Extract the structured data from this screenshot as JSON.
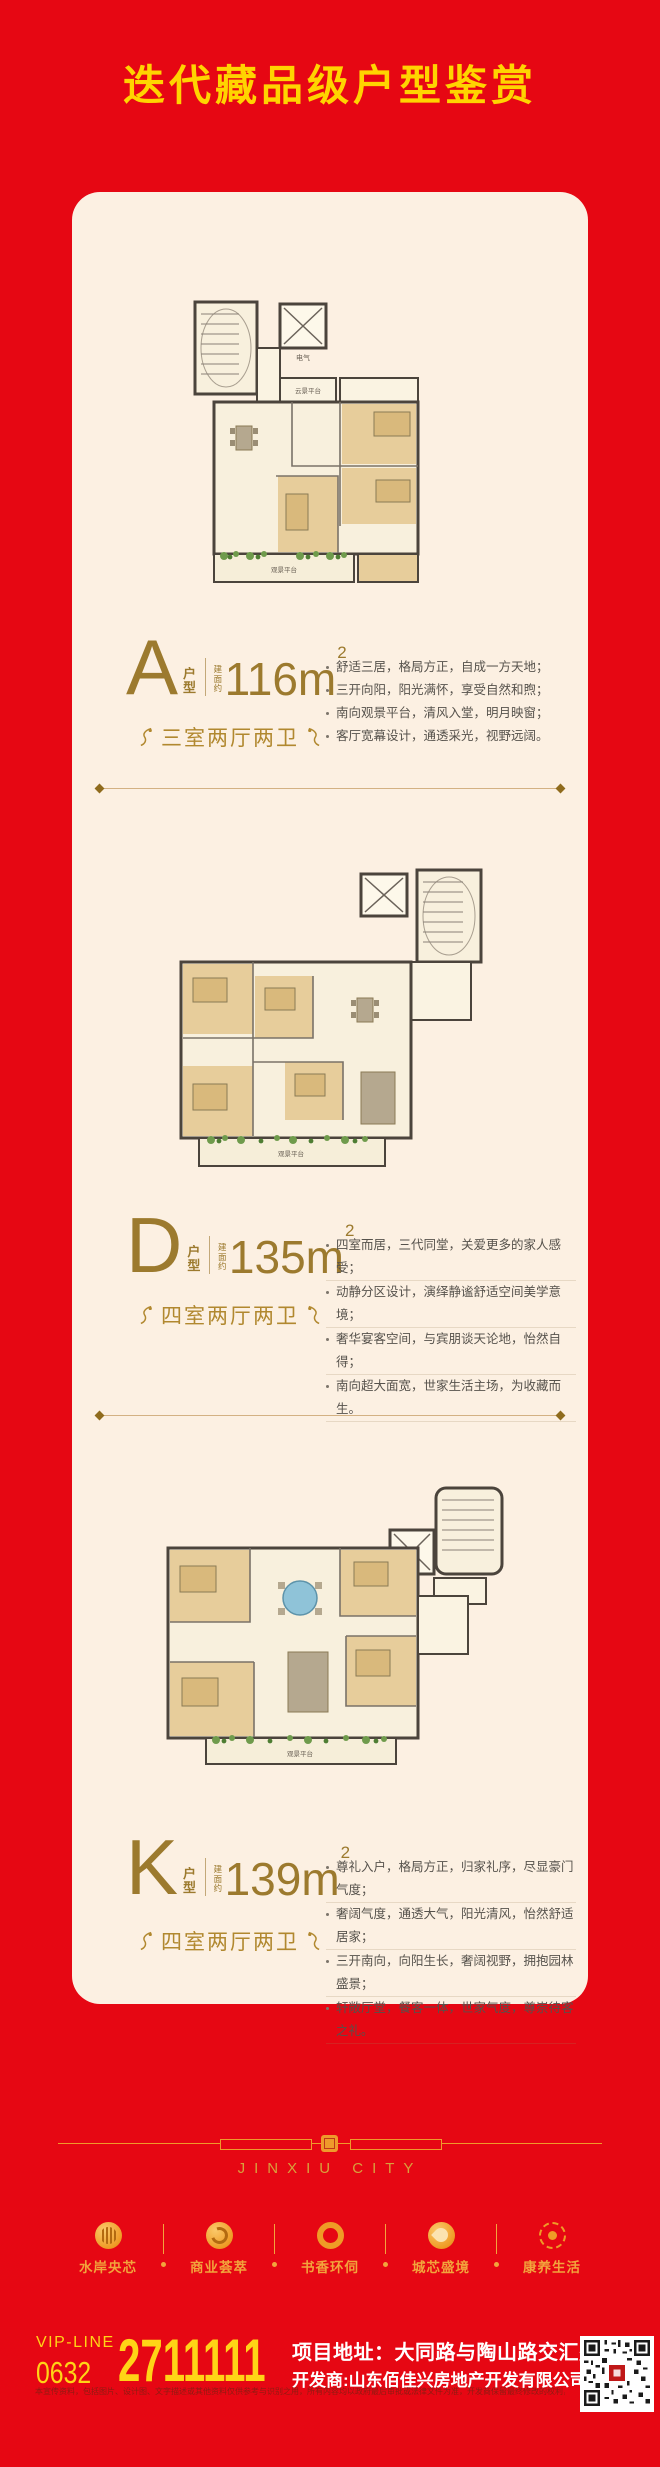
{
  "header": {
    "title": "迭代藏品级户型鉴赏"
  },
  "units": [
    {
      "letter": "A",
      "type_label": "户型",
      "area_prefix": "建面约",
      "area_main": "116m",
      "area_sup": "2",
      "layout_label": "三室两厅两卫",
      "bullets": [
        "舒适三居，格局方正，自成一方天地；",
        "三开向阳，阳光满怀，享受自然和煦；",
        "南向观景平台，清风入堂，明月映窗；",
        "客厅宽幕设计，通透采光，视野远阔。"
      ],
      "plan_labels": {
        "elec": "电气",
        "balcony": "云景平台",
        "terrace": "观景平台"
      }
    },
    {
      "letter": "D",
      "type_label": "户型",
      "area_prefix": "建面约",
      "area_main": "135m",
      "area_sup": "2",
      "layout_label": "四室两厅两卫",
      "bullets": [
        "四室而居，三代同堂，关爱更多的家人感受；",
        "动静分区设计，演绎静谧舒适空间美学意境；",
        "奢华宴客空间，与宾朋谈天论地，怡然自得；",
        "南向超大面宽，世家生活主场，为收藏而生。"
      ],
      "plan_labels": {
        "terrace": "观景平台"
      }
    },
    {
      "letter": "K",
      "type_label": "户型",
      "area_prefix": "建面约",
      "area_main": "139m",
      "area_sup": "2",
      "layout_label": "四室两厅两卫",
      "bullets": [
        "尊礼入户，格局方正，归家礼序，尽显豪门气度；",
        "奢阔气度，通透大气，阳光清风，怡然舒适居家；",
        "三开南向，向阳生长，奢阔视野，拥抱园林盛景；",
        "轩敞厅堂，餐客一体，世家气度，尊崇待客之礼。"
      ],
      "plan_labels": {
        "terrace": "观景平台"
      }
    }
  ],
  "footer": {
    "brand": "JINXIU CITY",
    "features": [
      {
        "label": "水岸央芯",
        "icon": "water-icon"
      },
      {
        "label": "商业荟萃",
        "icon": "business-icon"
      },
      {
        "label": "书香环伺",
        "icon": "book-icon"
      },
      {
        "label": "城芯盛境",
        "icon": "city-icon"
      },
      {
        "label": "康养生活",
        "icon": "health-icon"
      }
    ],
    "vip_line_label": "VIP-LINE",
    "area_code": "0632",
    "phone": "2711111",
    "address_line1": "项目地址：大同路与陶山路交汇处",
    "address_line2": "开发商:山东佰佳兴房地产开发有限公司",
    "disclaimer": "本宣传资料，包括图片、设计图、文字描述或其他资料仅供参考与识别之用，所有内容均以政府最后审批或法律文件为准，开发商保留最终修改的权利，敬请留意最新资料。"
  },
  "colors": {
    "background_red": "#e60713",
    "title_yellow": "#ffd400",
    "card_cream": "#fcf0e2",
    "gold_text": "#9c7a2e",
    "footer_gold": "#ef9a2b",
    "phone_yellow": "#ffd416"
  }
}
